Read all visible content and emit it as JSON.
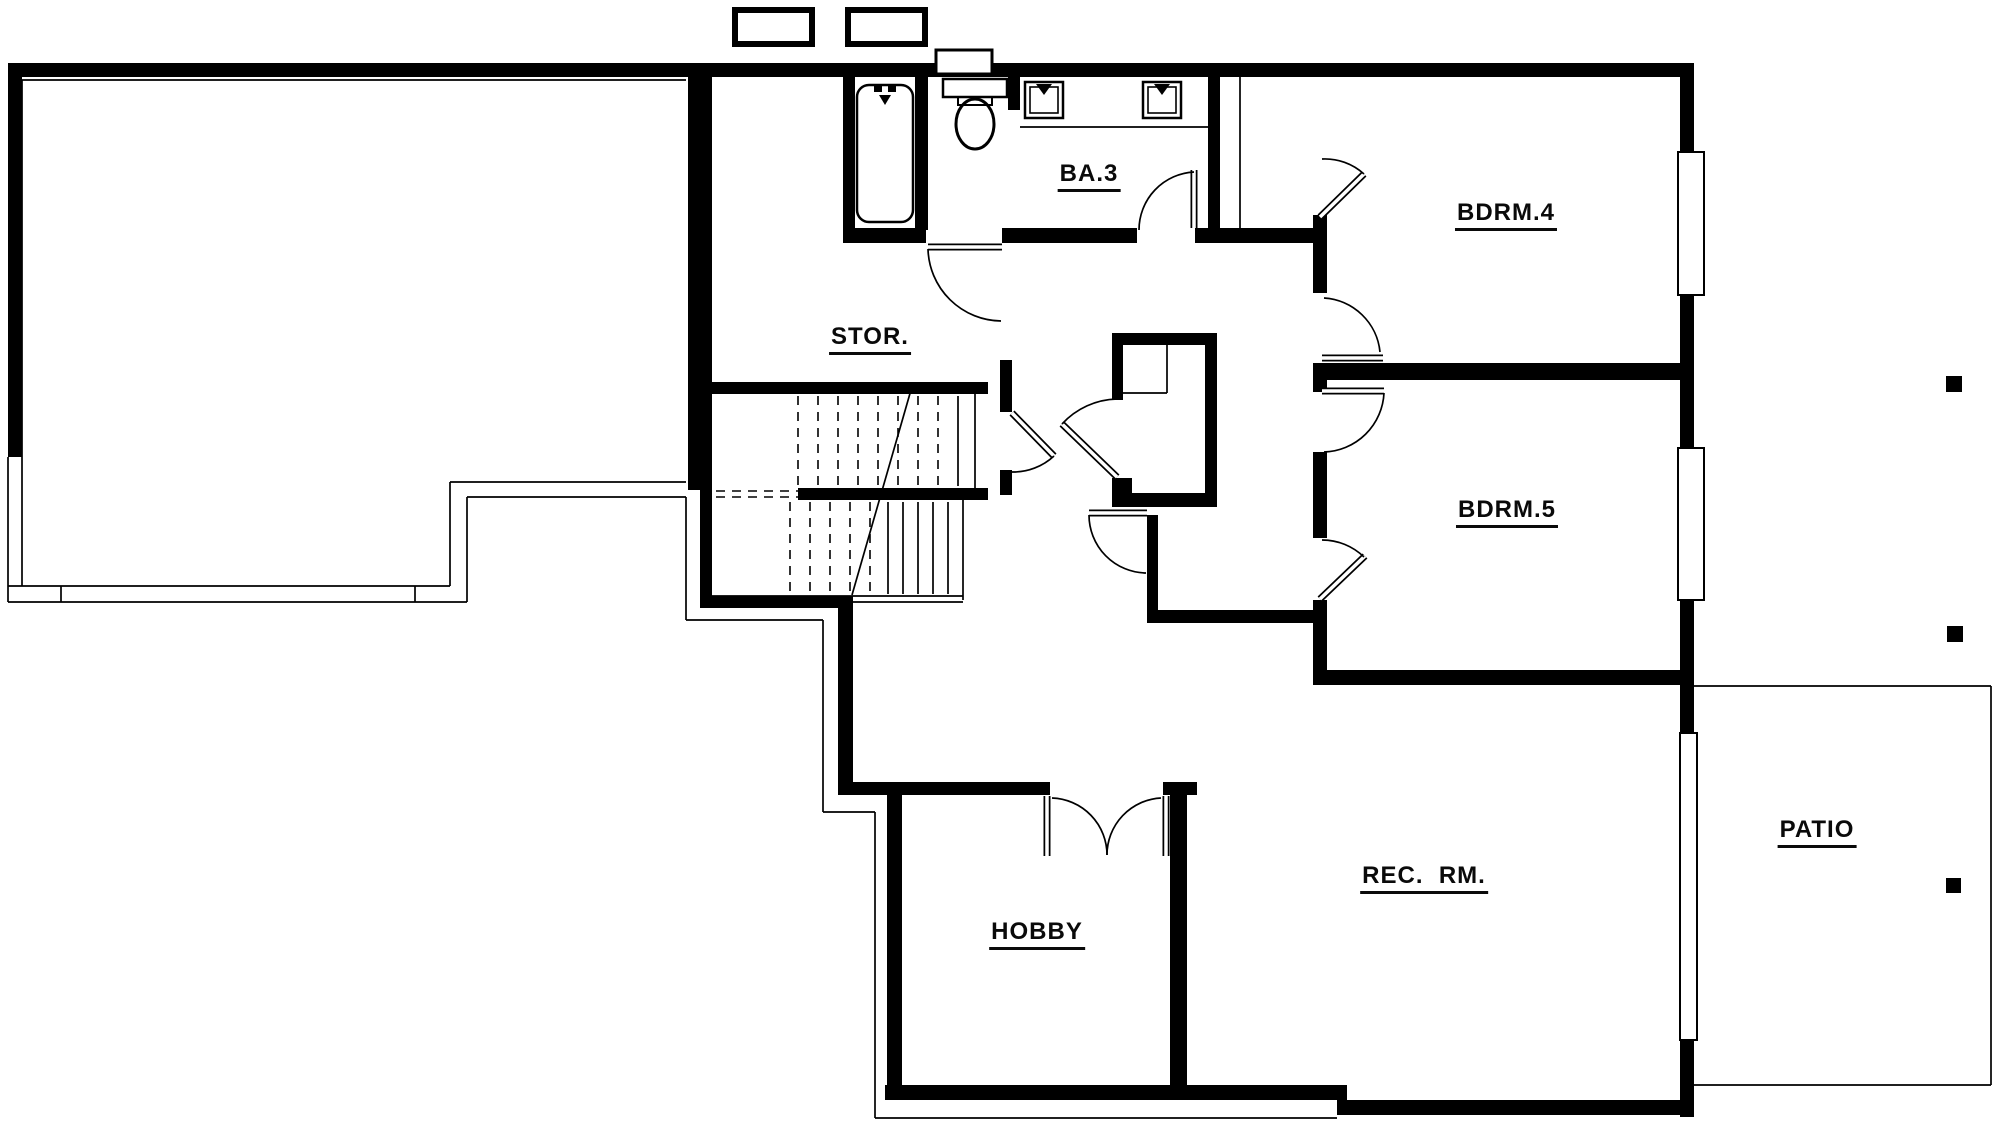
{
  "title": "Floor Plan",
  "plan": {
    "canvas": {
      "w": 2001,
      "h": 1125,
      "bg": "#ffffff",
      "ink": "#000000"
    },
    "rooms": [
      {
        "id": "stor",
        "label": "STOR.",
        "x": 870,
        "y": 340
      },
      {
        "id": "ba3",
        "label": "BA.3",
        "x": 1089,
        "y": 177
      },
      {
        "id": "bdrm4",
        "label": "BDRM.4",
        "x": 1506,
        "y": 216
      },
      {
        "id": "bdrm5",
        "label": "BDRM.5",
        "x": 1507,
        "y": 513
      },
      {
        "id": "hobby",
        "label": "HOBBY",
        "x": 1037,
        "y": 935
      },
      {
        "id": "rec-rm",
        "label": "REC.  RM.",
        "x": 1424,
        "y": 879
      },
      {
        "id": "patio",
        "label": "PATIO",
        "x": 1817,
        "y": 833
      }
    ],
    "walls": [
      [
        8,
        63,
        1686,
        14
      ],
      [
        8,
        63,
        14,
        394
      ],
      [
        688,
        63,
        24,
        427
      ],
      [
        1680,
        63,
        14,
        89
      ],
      [
        1680,
        295,
        14,
        153
      ],
      [
        1680,
        600,
        14,
        133
      ],
      [
        1680,
        1040,
        14,
        77
      ],
      [
        843,
        72,
        12,
        161
      ],
      [
        915,
        72,
        13,
        158
      ],
      [
        1008,
        63,
        12,
        47
      ],
      [
        1208,
        63,
        12,
        172
      ],
      [
        843,
        228,
        83,
        15
      ],
      [
        1002,
        228,
        135,
        15
      ],
      [
        1195,
        228,
        130,
        15
      ],
      [
        1313,
        215,
        14,
        78
      ],
      [
        1313,
        380,
        14,
        12
      ],
      [
        1313,
        452,
        14,
        86
      ],
      [
        1313,
        600,
        14,
        85
      ],
      [
        1313,
        363,
        381,
        17
      ],
      [
        1313,
        670,
        381,
        15
      ],
      [
        700,
        382,
        288,
        12
      ],
      [
        700,
        382,
        12,
        226
      ],
      [
        700,
        596,
        153,
        12
      ],
      [
        798,
        488,
        190,
        12
      ],
      [
        1000,
        360,
        12,
        52
      ],
      [
        1000,
        470,
        12,
        25
      ],
      [
        838,
        600,
        15,
        195
      ],
      [
        838,
        782,
        212,
        13
      ],
      [
        1163,
        782,
        34,
        13
      ],
      [
        887,
        795,
        15,
        300
      ],
      [
        1170,
        795,
        17,
        300
      ],
      [
        885,
        1085,
        462,
        15
      ],
      [
        1337,
        1100,
        357,
        15
      ],
      [
        1123,
        493,
        94,
        14
      ],
      [
        1147,
        610,
        166,
        13
      ],
      [
        1147,
        515,
        11,
        100
      ],
      [
        1112,
        333,
        105,
        12
      ],
      [
        1205,
        333,
        12,
        174
      ],
      [
        1112,
        333,
        11,
        67
      ],
      [
        1112,
        478,
        20,
        29
      ]
    ],
    "thin_lines": [
      [
        22,
        80,
        686,
        80
      ],
      [
        22,
        80,
        22,
        586
      ],
      [
        8,
        457,
        8,
        602
      ],
      [
        8,
        586,
        450,
        586
      ],
      [
        8,
        602,
        467,
        602
      ],
      [
        450,
        482,
        450,
        586
      ],
      [
        467,
        497,
        467,
        602
      ],
      [
        450,
        482,
        686,
        482
      ],
      [
        467,
        497,
        686,
        497
      ],
      [
        61,
        586,
        61,
        602
      ],
      [
        415,
        586,
        415,
        602
      ],
      [
        686,
        497,
        686,
        620
      ],
      [
        686,
        620,
        823,
        620
      ],
      [
        823,
        620,
        823,
        812
      ],
      [
        823,
        812,
        875,
        812
      ],
      [
        875,
        812,
        875,
        1118
      ],
      [
        875,
        1118,
        1337,
        1118
      ],
      [
        1020,
        127,
        1208,
        127
      ],
      [
        1240,
        77,
        1240,
        228
      ],
      [
        1167,
        345,
        1167,
        393
      ],
      [
        1123,
        393,
        1167,
        393
      ],
      [
        975,
        394,
        975,
        488
      ],
      [
        958,
        396,
        958,
        486
      ],
      [
        712,
        596,
        963,
        596
      ],
      [
        712,
        602,
        963,
        602
      ],
      [
        963,
        500,
        963,
        600
      ],
      [
        888,
        502,
        888,
        594
      ],
      [
        903,
        502,
        903,
        594
      ],
      [
        918,
        502,
        918,
        594
      ],
      [
        933,
        502,
        933,
        594
      ],
      [
        948,
        502,
        948,
        594
      ],
      [
        852,
        595,
        913,
        383
      ],
      [
        1689,
        154,
        1689,
        293
      ],
      [
        1689,
        450,
        1689,
        598
      ],
      [
        1684,
        740,
        1684,
        893
      ],
      [
        1691,
        885,
        1691,
        1037
      ],
      [
        1694,
        686,
        1991,
        686
      ],
      [
        1991,
        686,
        1991,
        1085
      ],
      [
        1694,
        1085,
        1991,
        1085
      ]
    ],
    "dashed_lines": [
      [
        798,
        396,
        798,
        486
      ],
      [
        818,
        396,
        818,
        486
      ],
      [
        838,
        396,
        838,
        486
      ],
      [
        858,
        396,
        858,
        486
      ],
      [
        878,
        396,
        878,
        486
      ],
      [
        898,
        396,
        898,
        486
      ],
      [
        918,
        396,
        918,
        486
      ],
      [
        938,
        396,
        938,
        486
      ],
      [
        716,
        491,
        798,
        491
      ],
      [
        716,
        497,
        798,
        497
      ],
      [
        790,
        502,
        790,
        594
      ],
      [
        810,
        502,
        810,
        594
      ],
      [
        830,
        502,
        830,
        594
      ],
      [
        850,
        502,
        850,
        594
      ],
      [
        870,
        502,
        870,
        594
      ]
    ],
    "door_leaves": [
      [
        1320,
        217,
        1364,
        174
      ],
      [
        1322,
        358,
        1383,
        358
      ],
      [
        1322,
        391,
        1384,
        391
      ],
      [
        1320,
        599,
        1365,
        556
      ],
      [
        1012,
        413,
        1054,
        456
      ],
      [
        1117,
        477,
        1062,
        424
      ],
      [
        928,
        247,
        1002,
        247
      ],
      [
        1194,
        170,
        1194,
        228
      ],
      [
        1089,
        513,
        1147,
        513
      ],
      [
        1047,
        796,
        1047,
        856
      ],
      [
        1166,
        796,
        1166,
        856
      ]
    ],
    "door_arcs": [
      "M 1322 159 A 58 58 0 0 1 1364 174",
      "M 1324 298 A 60 60 0 0 1 1380 352",
      "M 1384 393 A 62 62 0 0 1 1324 452",
      "M 1322 540 A 60 60 0 0 1 1364 557",
      "M 1054 456 A 60 60 0 0 1 1012 472",
      "M 1062 424 A 77 77 0 0 1 1117 399",
      "M 928 249 A 74 74 0 0 0 1001 321",
      "M 1139 230 A 58 58 0 0 1 1194 172",
      "M 1089 515 A 58 58 0 0 0 1146 573",
      "M 1052 798 A 57 57 0 0 1 1107 855",
      "M 1161 798 A 57 57 0 0 0 1107 855"
    ],
    "windows": [
      {
        "x": 1678,
        "y": 152,
        "w": 26,
        "h": 143
      },
      {
        "x": 1678,
        "y": 448,
        "w": 26,
        "h": 152
      },
      {
        "x": 1680,
        "y": 733,
        "w": 17,
        "h": 307
      }
    ],
    "chimneys": [
      {
        "x": 735,
        "y": 10,
        "w": 77,
        "h": 34
      },
      {
        "x": 848,
        "y": 10,
        "w": 77,
        "h": 34
      }
    ],
    "post_markers": [
      {
        "x": 1946,
        "y": 376,
        "s": 16
      },
      {
        "x": 1947,
        "y": 626,
        "s": 16
      },
      {
        "x": 1946,
        "y": 878,
        "s": 15
      }
    ],
    "fixtures": {
      "tub": {
        "x": 857,
        "y": 85,
        "w": 56,
        "h": 137,
        "r": 12,
        "knobs": [
          [
            874,
            85,
            8,
            7
          ],
          [
            888,
            85,
            8,
            7
          ]
        ],
        "spout": [
          879,
          95,
          891,
          95,
          885,
          105
        ]
      },
      "toilet": {
        "tank": [
          943,
          79,
          64,
          18
        ],
        "seat": [
          958,
          97,
          34,
          8
        ],
        "bowl": {
          "cx": 975,
          "cy": 124,
          "rx": 19,
          "ry": 25
        }
      },
      "niche": {
        "x": 936,
        "y": 50,
        "w": 56,
        "h": 24
      },
      "sinks": [
        {
          "x": 1025,
          "y": 82,
          "s": 38
        },
        {
          "x": 1143,
          "y": 82,
          "s": 38
        }
      ]
    }
  }
}
